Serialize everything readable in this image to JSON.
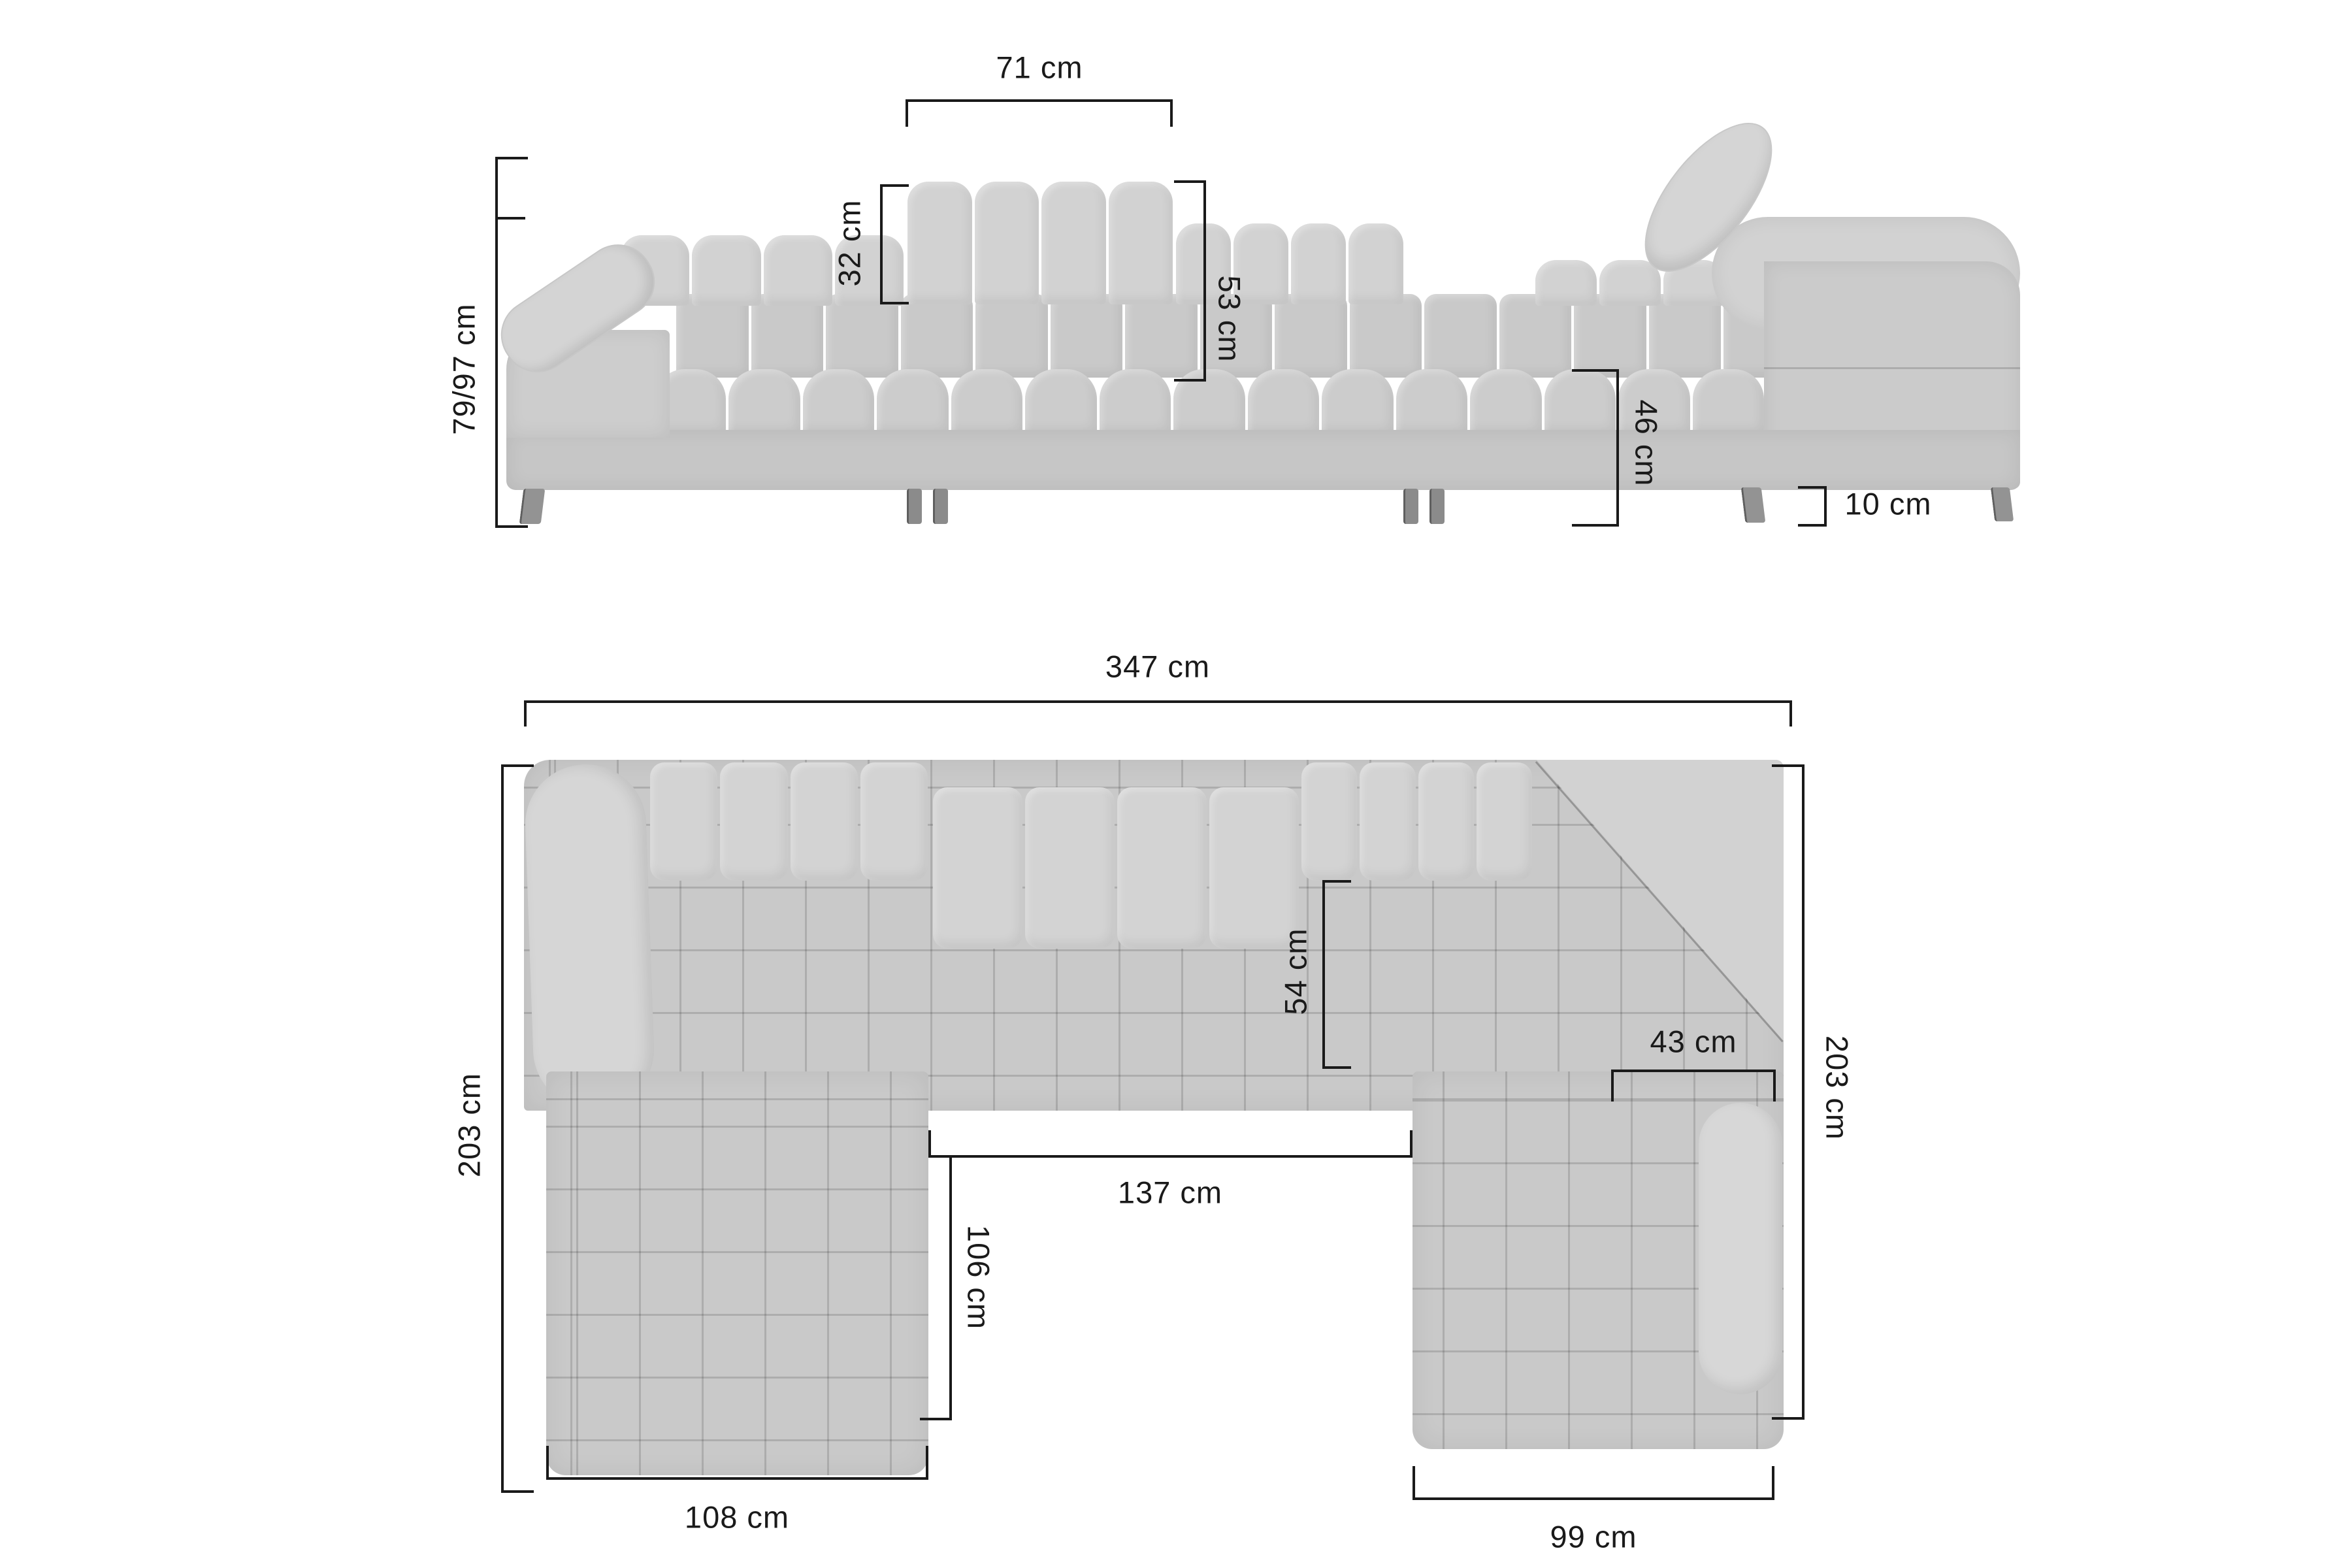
{
  "front": {
    "headrest_width": "71 cm",
    "headrest_rise": "32 cm",
    "back_height": "53 cm",
    "total_height": "79/97 cm",
    "seat_height": "46 cm",
    "leg_height": "10 cm"
  },
  "plan": {
    "total_width": "347 cm",
    "left_depth": "203 cm",
    "right_depth": "203 cm",
    "seat_depth": "54 cm",
    "armrest_width": "43 cm",
    "inner_width": "137 cm",
    "inner_length": "106 cm",
    "left_chaise_width": "108 cm",
    "right_chaise_width": "99 cm"
  },
  "colors": {
    "fabric": "#cbcbcb",
    "fabric_light": "#d6d6d6",
    "dimension_line": "#1a1a1a"
  }
}
